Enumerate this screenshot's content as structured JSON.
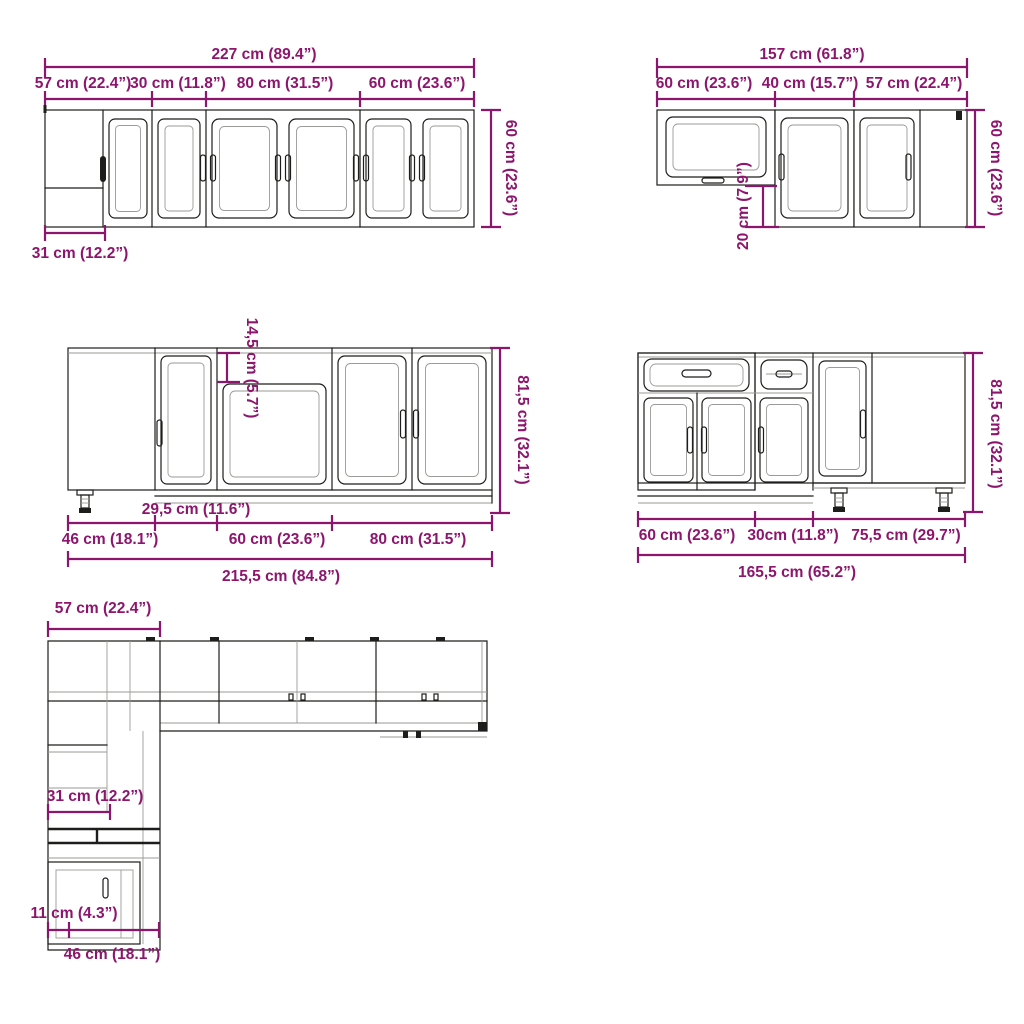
{
  "colors": {
    "dimension": "#8C156D",
    "outline": "#1D1D1B",
    "light_line": "#9A9A97"
  },
  "wall_row_left": {
    "total": "227 cm (89.4”)",
    "segments": [
      "57 cm (22.4”)",
      "30 cm (11.8”)",
      "80 cm (31.5”)",
      "60 cm (23.6”)"
    ],
    "height": "60 cm (23.6”)",
    "corner_depth": "31 cm (12.2”)"
  },
  "wall_row_right": {
    "total": "157 cm (61.8”)",
    "segments": [
      "60 cm (23.6”)",
      "40 cm (15.7”)",
      "57 cm (22.4”)"
    ],
    "height": "60 cm (23.6”)",
    "height_offset": "20 cm (7.9”)"
  },
  "base_row_left": {
    "total": "215,5 cm (84.8”)",
    "segments": [
      "46 cm (18.1”)",
      "60 cm (23.6”)",
      "80 cm (31.5”)"
    ],
    "corner_front_width": "29,5 cm (11.6”)",
    "sink_top_drop": "14,5 cm (5.7”)",
    "height": "81,5 cm (32.1”)"
  },
  "base_row_right": {
    "total": "165,5 cm (65.2”)",
    "segments": [
      "60 cm (23.6”)",
      "30cm (11.8”)",
      "75,5 cm (29.7”)"
    ],
    "height": "81,5 cm (32.1”)"
  },
  "plan_view": {
    "corner_width": "57 cm (22.4”)",
    "wall_depth": "31 cm (12.2”)",
    "side_gap": "11 cm (4.3”)",
    "base_depth": "46 cm (18.1”)"
  }
}
